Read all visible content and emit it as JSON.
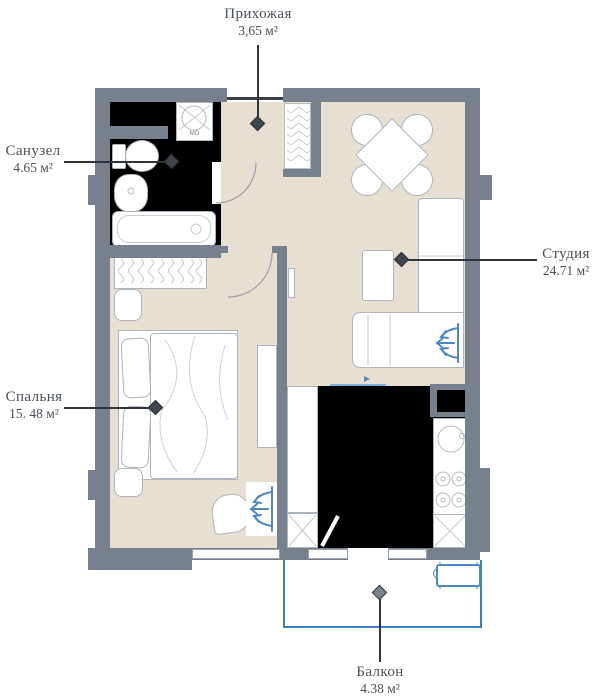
{
  "rooms": {
    "hallway": {
      "name": "Прихожая",
      "area": "3,65 м²"
    },
    "bathroom": {
      "name": "Санузел",
      "area": "4.65 м²"
    },
    "studio": {
      "name": "Студия",
      "area": "24.71 м²"
    },
    "bedroom": {
      "name": "Спальня",
      "area": "15. 48 м²"
    },
    "balcony": {
      "name": "Балкон",
      "area": "4.38 м²"
    }
  },
  "appliances": {
    "washing_machine_label": "МО"
  },
  "colors": {
    "wall": "#76818D",
    "floor": "#E8DFD3",
    "wet": "#000000",
    "blue": "#4C88C6",
    "bluelight": "#7FB0DA",
    "text": "#4A5159",
    "line": "#2F343B"
  }
}
